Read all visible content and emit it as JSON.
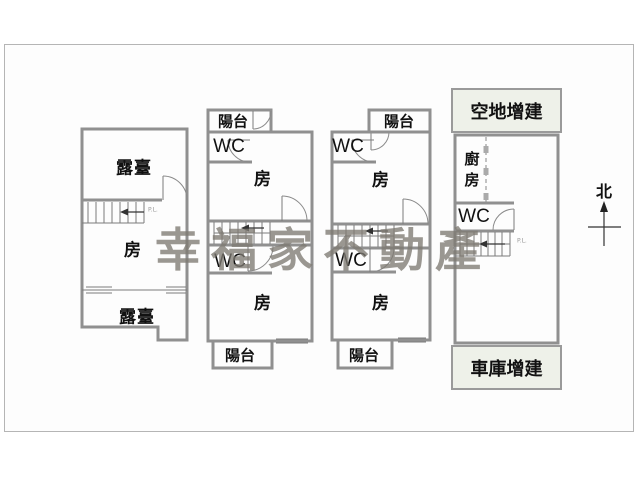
{
  "watermark": {
    "text": "幸福家不動產",
    "color": "#7d7a72"
  },
  "compass": {
    "label": "北"
  },
  "unit1": {
    "terrace_top": "露臺",
    "room": "房",
    "terrace_bottom": "露臺",
    "stair_label": "P.L."
  },
  "unit2": {
    "balcony_top": "陽台",
    "wc_upper": "WC",
    "room_upper": "房",
    "wc_lower": "WC",
    "room_lower": "房",
    "balcony_bottom": "陽台"
  },
  "unit3": {
    "balcony_top": "陽台",
    "wc_upper": "WC",
    "room_upper": "房",
    "wc_lower": "WC",
    "room_lower": "房",
    "balcony_bottom": "陽台"
  },
  "unit4": {
    "annotation_top": "空地增建",
    "kitchen": "廚房",
    "wc": "WC",
    "stair_label": "P.L.",
    "annotation_bottom": "車庫增建"
  },
  "colors": {
    "wall": "#909090",
    "annotation_bg": "#eef1e9",
    "frame": "#b5b5b5",
    "label_text": "#111111"
  }
}
